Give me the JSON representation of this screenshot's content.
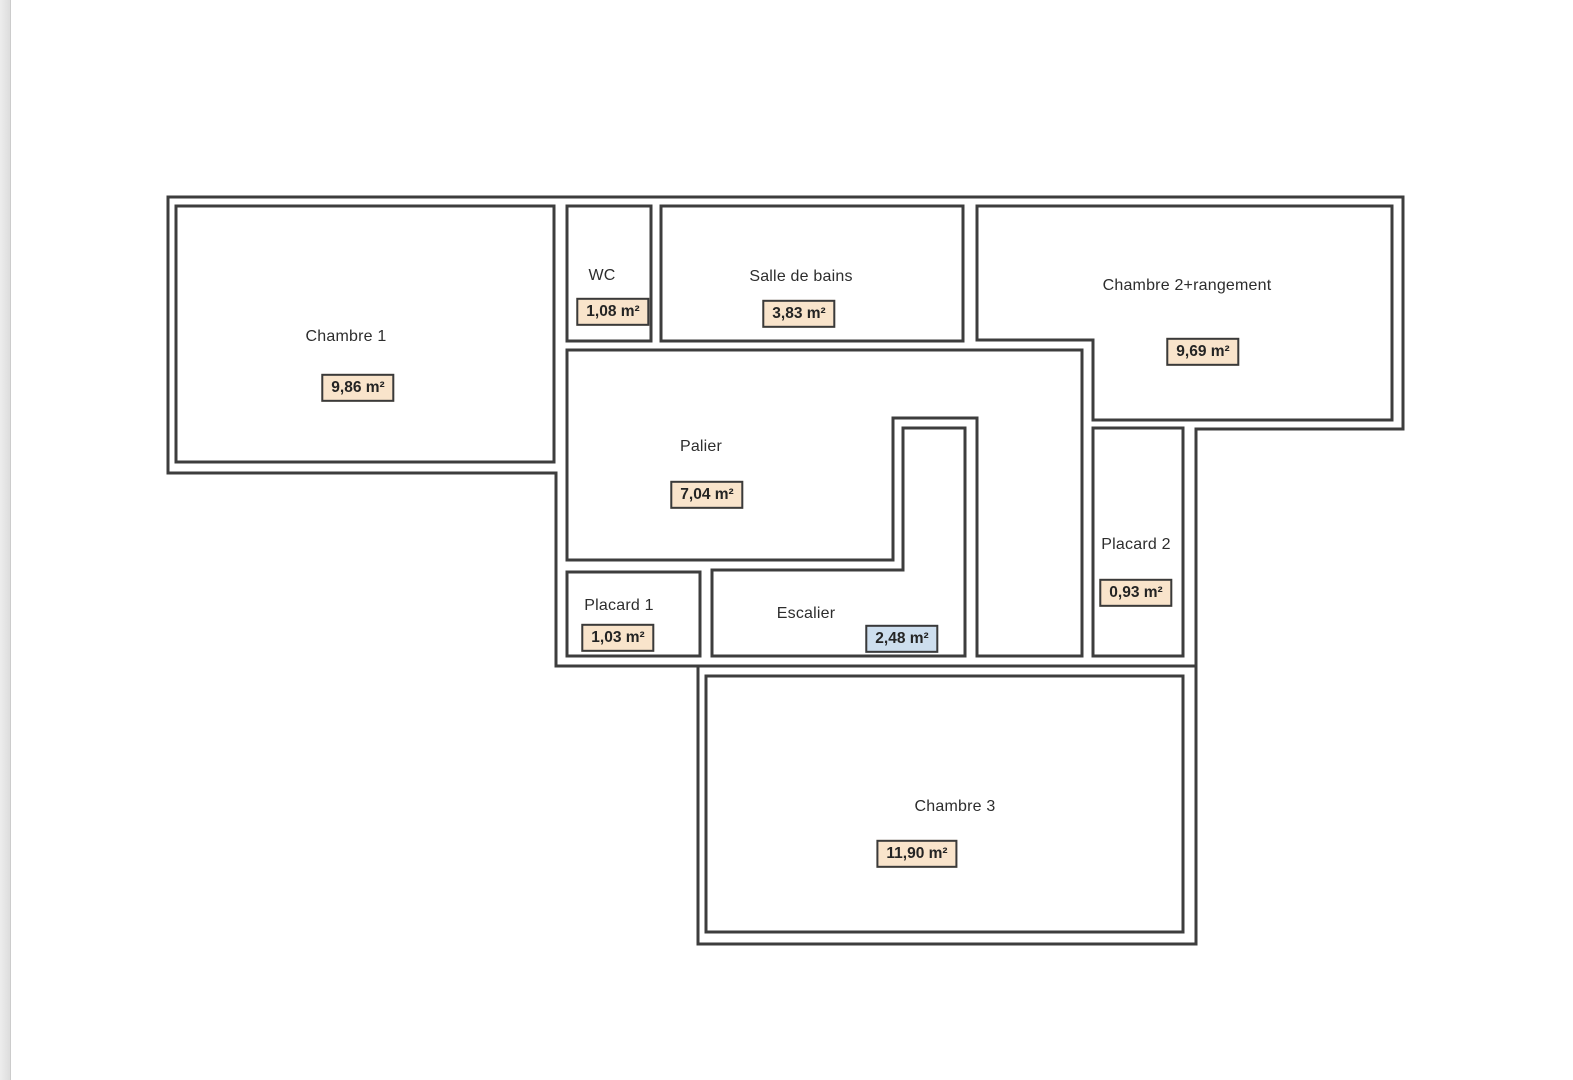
{
  "canvas": {
    "width": 1573,
    "height": 1080,
    "background": "#ffffff",
    "left_edge_strip_color": "#e5e5e5"
  },
  "plan": {
    "wall_color": "#3d3d3d",
    "text_color": "#2d2d2d",
    "badge_border_color": "#3a3a3a",
    "badge_colors": {
      "tan": "#f9e4cb",
      "blue": "#cddeee"
    },
    "rooms": [
      {
        "id": "chambre-1",
        "label": "Chambre 1",
        "area": "9,86 m²",
        "badge": "tan"
      },
      {
        "id": "wc",
        "label": "WC",
        "area": "1,08 m²",
        "badge": "tan"
      },
      {
        "id": "salle-de-bains",
        "label": "Salle de bains",
        "area": "3,83 m²",
        "badge": "tan"
      },
      {
        "id": "chambre-2-rangement",
        "label": "Chambre 2+rangement",
        "area": "9,69 m²",
        "badge": "tan"
      },
      {
        "id": "palier",
        "label": "Palier",
        "area": "7,04 m²",
        "badge": "tan"
      },
      {
        "id": "placard-1",
        "label": "Placard 1",
        "area": "1,03 m²",
        "badge": "tan"
      },
      {
        "id": "escalier",
        "label": "Escalier",
        "area": "2,48 m²",
        "badge": "blue"
      },
      {
        "id": "placard-2",
        "label": "Placard 2",
        "area": "0,93 m²",
        "badge": "tan"
      },
      {
        "id": "chambre-3",
        "label": "Chambre 3",
        "area": "11,90 m²",
        "badge": "tan"
      }
    ]
  }
}
